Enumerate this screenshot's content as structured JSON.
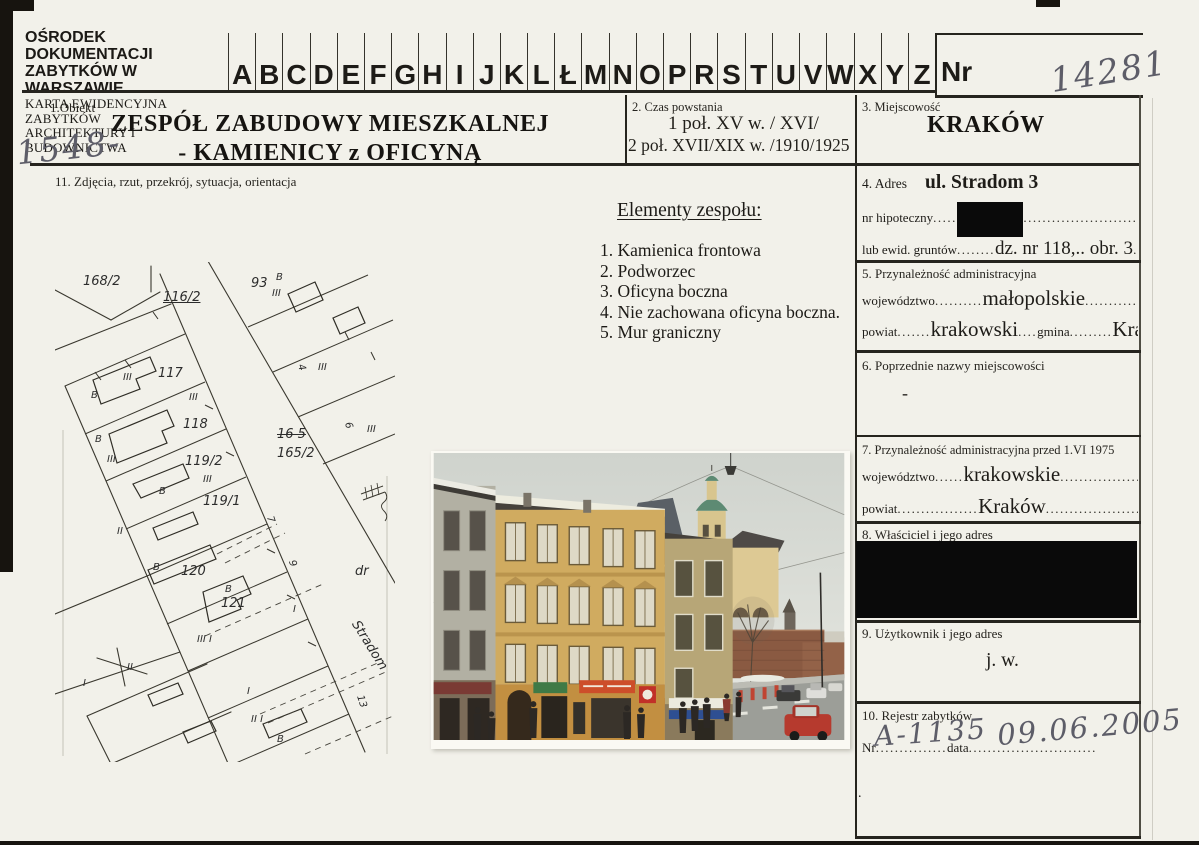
{
  "scan": {
    "hw_card_no": "14281",
    "hw_side_no": "1548-"
  },
  "header": {
    "org1": "OŚRODEK DOKUMENTACJI",
    "org2": "ZABYTKÓW W WARSZAWIE",
    "card1": "KARTA EWIDENCYJNA ZABYTKÓW",
    "card2": "ARCHITEKTURY I BUDOWNICTWA",
    "letters": [
      "A",
      "B",
      "C",
      "D",
      "E",
      "F",
      "G",
      "H",
      "I",
      "J",
      "K",
      "L",
      "Ł",
      "M",
      "N",
      "O",
      "P",
      "R",
      "S",
      "T",
      "U",
      "V",
      "W",
      "X",
      "Y",
      "Z"
    ],
    "nr_label": "Nr"
  },
  "s1": {
    "label": "1.Obiekt",
    "title1": "ZESPÓŁ ZABUDOWY MIESZKALNEJ",
    "title2": "- KAMIENICY z OFICYNĄ"
  },
  "s2": {
    "label": "2. Czas powstania",
    "line1": "1 poł. XV w. / XVI/",
    "line2": "2 poł. XVII/XIX w. /1910/1925"
  },
  "s3": {
    "label": "3. Miejscowość",
    "value": "KRAKÓW"
  },
  "s4": {
    "label": "4. Adres",
    "value": "ul. Stradom 3",
    "r1_label": "nr hipoteczny",
    "r1_dots": "..........................................................",
    "r2_label": "lub ewid. gruntów",
    "r2_dots1": "........",
    "r2_value": "dz. nr 118,.. obr. 3",
    "r2_dots2": "............."
  },
  "s5": {
    "label": "5. Przynależność administracyjna",
    "r1_label": "województwo",
    "r1_dots1": "..........",
    "r1_value": "małopolskie",
    "r1_dots2": "......................",
    "r2_label": "powiat",
    "r2_dots1": ".......",
    "r2_value1": "krakowski",
    "r2_dots2": "....",
    "r2_label2": "gmina",
    "r2_dots3": ".........",
    "r2_value2": "Kraków",
    "r2_dots4": "..."
  },
  "s6": {
    "label": "6. Poprzednie nazwy miejscowości",
    "value": "-"
  },
  "s7": {
    "label": "7. Przynależność administracyjna przed 1.VI 1975",
    "r1_label": "województwo",
    "r1_dots1": "......",
    "r1_value": "krakowskie",
    "r1_dots2": ".........................",
    "r2_label": "powiat",
    "r2_dots1": ".................",
    "r2_value": "Kraków",
    "r2_dots2": "..........................."
  },
  "s8": {
    "label": "8. Właściciel i jego adres"
  },
  "s9": {
    "label": "9. Użytkownik i jego adres",
    "value": "j. w."
  },
  "s10": {
    "label": "10. Rejestr zabytków",
    "nr_label": "Nr",
    "nr_dots": "...............",
    "hw_nr": "A-1135",
    "data_label": "data",
    "data_dots": "...........................",
    "hw_data": "09.06.2005",
    "footnote": "."
  },
  "s11": {
    "label": "11. Zdjęcia, rzut, przekrój, sytuacja, orientacja"
  },
  "elements": {
    "heading": "Elementy zespołu:",
    "items": [
      "1. Kamienica frontowa",
      "2. Podworzec",
      "3. Oficyna boczna",
      "4. Nie zachowana oficyna boczna.",
      "5. Mur graniczny"
    ]
  },
  "map": {
    "labels": [
      {
        "t": "168/2",
        "x": 28,
        "y": 12,
        "c": "lgl"
      },
      {
        "t": "116/2",
        "x": 108,
        "y": 28,
        "c": "lgl u"
      },
      {
        "t": "93",
        "x": 196,
        "y": 14,
        "c": "lgl"
      },
      {
        "t": "B",
        "x": 221,
        "y": 10,
        "c": "sml"
      },
      {
        "t": "III",
        "x": 217,
        "y": 26,
        "c": "sml"
      },
      {
        "t": "117",
        "x": 103,
        "y": 104,
        "c": "lgl"
      },
      {
        "t": "III",
        "x": 68,
        "y": 110,
        "c": "sml"
      },
      {
        "t": "B",
        "x": 36,
        "y": 128,
        "c": "sml"
      },
      {
        "t": "III",
        "x": 134,
        "y": 130,
        "c": "sml"
      },
      {
        "t": "118",
        "x": 128,
        "y": 155,
        "c": "lgl"
      },
      {
        "t": "B",
        "x": 40,
        "y": 172,
        "c": "sml"
      },
      {
        "t": "III",
        "x": 52,
        "y": 192,
        "c": "sml"
      },
      {
        "t": "16 5",
        "x": 222,
        "y": 165,
        "c": "lgl strike"
      },
      {
        "t": "165/2",
        "x": 222,
        "y": 184,
        "c": "lgl"
      },
      {
        "t": "119/2",
        "x": 130,
        "y": 192,
        "c": "lgl"
      },
      {
        "t": "III",
        "x": 148,
        "y": 212,
        "c": "sml"
      },
      {
        "t": "B",
        "x": 104,
        "y": 224,
        "c": "sml"
      },
      {
        "t": "119/1",
        "x": 148,
        "y": 232,
        "c": "lgl"
      },
      {
        "t": "4",
        "x": 243,
        "y": 100,
        "c": "sml r"
      },
      {
        "t": "III",
        "x": 263,
        "y": 100,
        "c": "sml"
      },
      {
        "t": "6",
        "x": 290,
        "y": 158,
        "c": "sml r"
      },
      {
        "t": "III",
        "x": 312,
        "y": 162,
        "c": "sml"
      },
      {
        "t": "7",
        "x": 212,
        "y": 252,
        "c": "sml r"
      },
      {
        "t": "9",
        "x": 234,
        "y": 296,
        "c": "sml r"
      },
      {
        "t": "B",
        "x": 98,
        "y": 300,
        "c": "sml"
      },
      {
        "t": "120",
        "x": 126,
        "y": 302,
        "c": "lgl"
      },
      {
        "t": "B",
        "x": 170,
        "y": 322,
        "c": "sml"
      },
      {
        "t": "121",
        "x": 166,
        "y": 334,
        "c": "lgl"
      },
      {
        "t": "I",
        "x": 238,
        "y": 342,
        "c": "sml"
      },
      {
        "t": "III I",
        "x": 142,
        "y": 372,
        "c": "sml"
      },
      {
        "t": "II",
        "x": 62,
        "y": 264,
        "c": "sml"
      },
      {
        "t": "II",
        "x": 72,
        "y": 400,
        "c": "sml"
      },
      {
        "t": "I",
        "x": 28,
        "y": 416,
        "c": "sml"
      },
      {
        "t": "I",
        "x": 192,
        "y": 424,
        "c": "sml"
      },
      {
        "t": "II I",
        "x": 196,
        "y": 452,
        "c": "sml"
      },
      {
        "t": "B",
        "x": 222,
        "y": 472,
        "c": "sml"
      },
      {
        "t": "dr",
        "x": 300,
        "y": 302,
        "c": "lgl"
      },
      {
        "t": "Stradom",
        "x": 306,
        "y": 356,
        "c": "lgl rot"
      },
      {
        "t": "13",
        "x": 300,
        "y": 434,
        "c": "sml r"
      }
    ]
  }
}
